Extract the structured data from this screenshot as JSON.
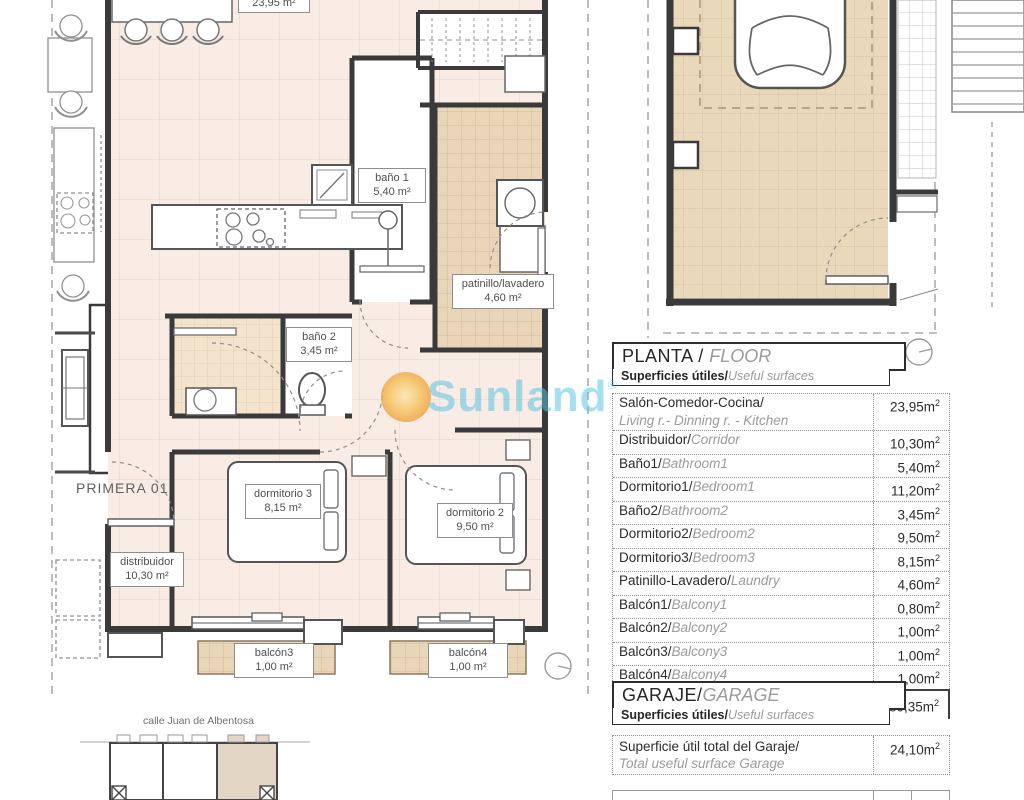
{
  "watermark": {
    "brand": "Sunland",
    "registered": "®"
  },
  "plan": {
    "entrance_label": "PRIMERA 01",
    "street_label": "calle Juan de Albentosa",
    "labels": {
      "salon_area": "23,95 m²",
      "bano1_name": "baño 1",
      "bano1_area": "5,40 m²",
      "patinillo_name": "patinillo/lavadero",
      "patinillo_area": "4,60 m²",
      "bano2_name": "baño 2",
      "bano2_area": "3,45 m²",
      "dormitorio3_name": "dormitorio 3",
      "dormitorio3_area": "8,15 m²",
      "dormitorio2_name": "dormitorio 2",
      "dormitorio2_area": "9,50 m²",
      "distribuidor_name": "distribuidor",
      "distribuidor_area": "10,30 m²",
      "balcon3_name": "balcón3",
      "balcon3_area": "1,00 m²",
      "balcon4_name": "balcón4",
      "balcon4_area": "1,00 m²"
    }
  },
  "planta": {
    "title": "PLANTA / ",
    "title_en": "FLOOR",
    "subtitle": "Superficies útiles/",
    "subtitle_en": "Useful surfaces",
    "sup": "2",
    "rows": [
      {
        "es": "Salón-Comedor-Cocina/",
        "en": "Living r.- Dinning r. - Kitchen",
        "value": "23,95m",
        "stack": true
      },
      {
        "es": "Distribuidor/",
        "en": "Corridor",
        "value": "10,30m"
      },
      {
        "es": "Baño1/",
        "en": "Bathroom1",
        "value": "5,40m"
      },
      {
        "es": "Dormitorio1/",
        "en": "Bedroom1",
        "value": "11,20m"
      },
      {
        "es": "Baño2/",
        "en": "Bathroom2",
        "value": "3,45m"
      },
      {
        "es": "Dormitorio2/",
        "en": "Bedroom2",
        "value": "9,50m"
      },
      {
        "es": "Dormitorio3/",
        "en": "Bedroom3",
        "value": "8,15m"
      },
      {
        "es": "Patinillo-Lavadero/",
        "en": "Laundry",
        "value": "4,60m"
      },
      {
        "es": "Balcón1/",
        "en": "Balcony1",
        "value": "0,80m"
      },
      {
        "es": "Balcón2/",
        "en": "Balcony2",
        "value": "1,00m"
      },
      {
        "es": "Balcón3/",
        "en": "Balcony3",
        "value": "1,00m"
      },
      {
        "es": "Balcón4/",
        "en": "Balcony4",
        "value": "1,00m"
      }
    ],
    "total": {
      "es": "Superficie útil total / ",
      "en": "Total useful surface",
      "value": "80,35m"
    }
  },
  "garaje": {
    "title": "GARAJE/",
    "title_en": "GARAGE",
    "subtitle": "Superficies útiles/",
    "subtitle_en": "Useful surfaces",
    "sup": "2",
    "row": {
      "es": "Superficie útil total del Garaje/",
      "en": "Total useful surface Garage",
      "value": "24,10m"
    }
  }
}
